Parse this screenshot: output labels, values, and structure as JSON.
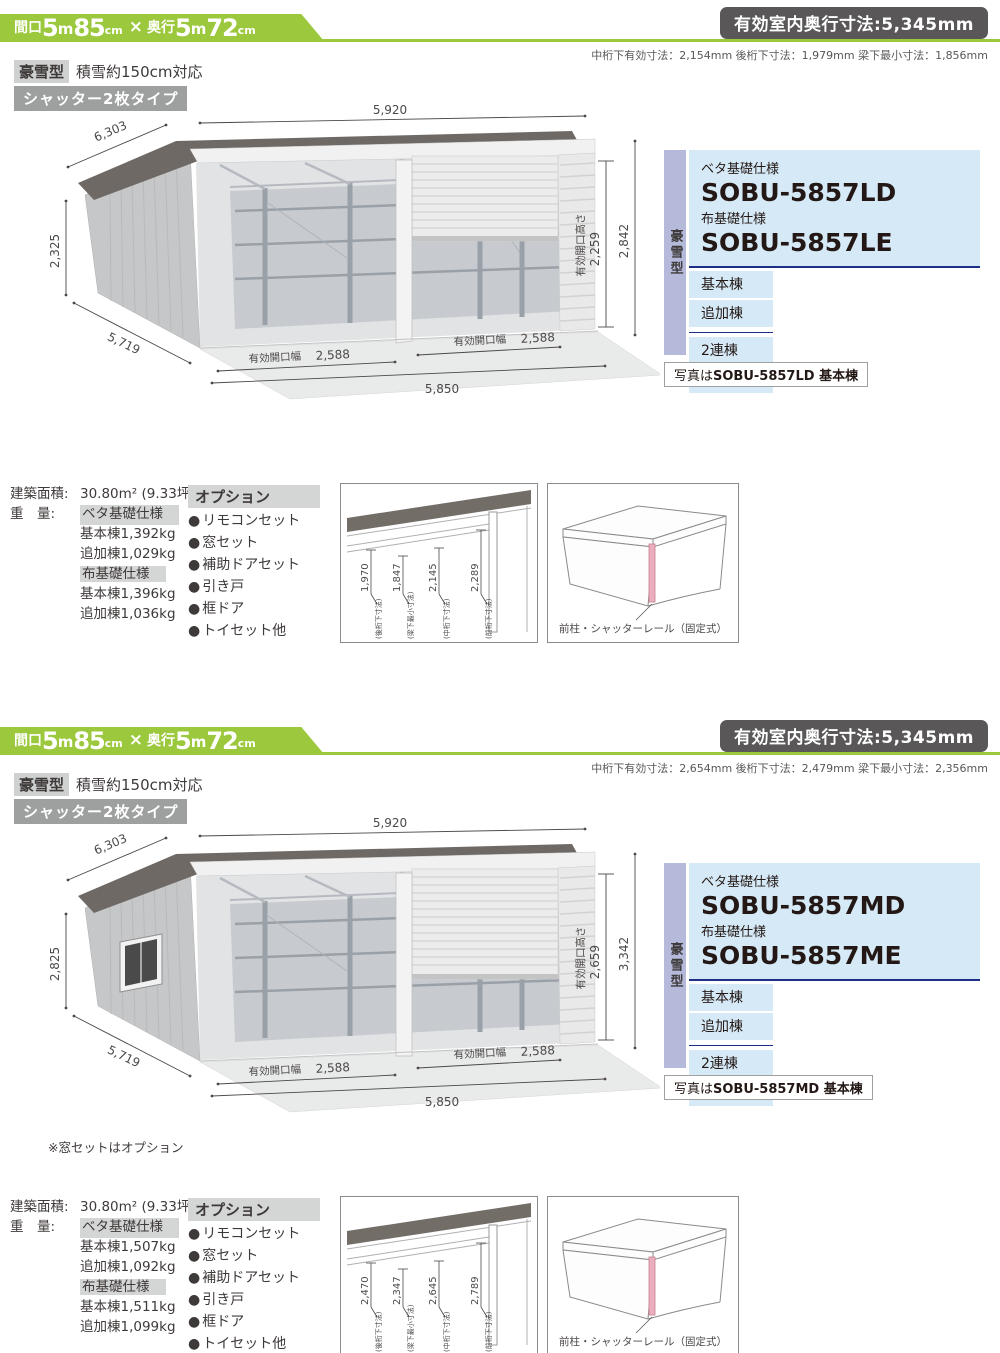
{
  "colors": {
    "accent_green": "#9cc83d",
    "badge_dark": "#595757",
    "badge_gray": "#9e9f9f",
    "panel_blue": "#d5e9f6",
    "panel_purple": "#b5badb",
    "navy_line": "#1d2e87",
    "pillar_pink": "#eaaebc"
  },
  "sections": [
    {
      "header": {
        "aperture_label": "間口",
        "a1": "5",
        "au1": "m",
        "a2": "85",
        "au2": "cm",
        "times": "×",
        "depth_label": "奥行",
        "d1": "5",
        "du1": "m",
        "d2": "72",
        "du2": "cm"
      },
      "room_badge": "有効室内奥行寸法:5,345mm",
      "subnote": "中桁下有効寸法：2,154mm 後桁下寸法：1,979mm 梁下最小寸法：1,856mm",
      "type_badge": "豪雪型",
      "type_note": "積雪約150cm対応",
      "shutter_badge": "シャッター2枚タイプ",
      "drawing": {
        "top": "5,920",
        "roof_diag": "6,303",
        "left_h": "2,325",
        "side_diag": "5,719",
        "outer_h": "2,842",
        "open_h_label": "有効開口高さ",
        "open_h": "2,259",
        "open_w_label": "有効開口幅",
        "open_w": "2,588",
        "total": "5,850"
      },
      "products": {
        "type_vertical": "豪雪型",
        "beta_label": "ベタ基礎仕様",
        "beta_model": "SOBU-5857LD",
        "nuno_label": "布基礎仕様",
        "nuno_model": "SOBU-5857LE",
        "units": [
          "基本棟",
          "追加棟"
        ],
        "multi": [
          "2連棟",
          "3連棟"
        ],
        "photo_prefix": "写真は",
        "photo_bold": "SOBU-5857LD 基本棟"
      },
      "specs": {
        "area_label": "建築面積:",
        "area_value": "30.80m² (9.33坪)",
        "weight_label": "重　量:",
        "beta_header": "ベタ基礎仕様",
        "rows_beta": [
          "基本棟1,392kg",
          "追加棟1,029kg"
        ],
        "nuno_header": "布基礎仕様",
        "rows_nuno": [
          "基本棟1,396kg",
          "追加棟1,036kg"
        ]
      },
      "options": {
        "title": "オプション",
        "bullet": "●",
        "items": [
          "リモコンセット",
          "窓セット",
          "補助ドアセット",
          "引き戸",
          "框ドア",
          "トイセット他"
        ]
      },
      "section_diagram": {
        "dims": [
          "1,970",
          "1,847",
          "2,145",
          "2,289"
        ],
        "labels": [
          "(後桁下寸法)",
          "(梁下最小寸法)",
          "(中桁下寸法)",
          "(前桁下寸法)"
        ]
      },
      "pillar_diagram": {
        "label": "前柱・シャッターレール（固定式）"
      }
    },
    {
      "header": {
        "aperture_label": "間口",
        "a1": "5",
        "au1": "m",
        "a2": "85",
        "au2": "cm",
        "times": "×",
        "depth_label": "奥行",
        "d1": "5",
        "du1": "m",
        "d2": "72",
        "du2": "cm"
      },
      "room_badge": "有効室内奥行寸法:5,345mm",
      "subnote": "中桁下有効寸法：2,654mm 後桁下寸法：2,479mm 梁下最小寸法：2,356mm",
      "type_badge": "豪雪型",
      "type_note": "積雪約150cm対応",
      "shutter_badge": "シャッター2枚タイプ",
      "drawing": {
        "top": "5,920",
        "roof_diag": "6,303",
        "left_h": "2,825",
        "side_diag": "5,719",
        "outer_h": "3,342",
        "open_h_label": "有効開口高さ",
        "open_h": "2,659",
        "open_w_label": "有効開口幅",
        "open_w": "2,588",
        "total": "5,850",
        "window_note": "※窓セットはオプション"
      },
      "products": {
        "type_vertical": "豪雪型",
        "beta_label": "ベタ基礎仕様",
        "beta_model": "SOBU-5857MD",
        "nuno_label": "布基礎仕様",
        "nuno_model": "SOBU-5857ME",
        "units": [
          "基本棟",
          "追加棟"
        ],
        "multi": [
          "2連棟",
          "3連棟"
        ],
        "photo_prefix": "写真は",
        "photo_bold": "SOBU-5857MD 基本棟"
      },
      "specs": {
        "area_label": "建築面積:",
        "area_value": "30.80m² (9.33坪)",
        "weight_label": "重　量:",
        "beta_header": "ベタ基礎仕様",
        "rows_beta": [
          "基本棟1,507kg",
          "追加棟1,092kg"
        ],
        "nuno_header": "布基礎仕様",
        "rows_nuno": [
          "基本棟1,511kg",
          "追加棟1,099kg"
        ]
      },
      "options": {
        "title": "オプション",
        "bullet": "●",
        "items": [
          "リモコンセット",
          "窓セット",
          "補助ドアセット",
          "引き戸",
          "框ドア",
          "トイセット他"
        ]
      },
      "section_diagram": {
        "dims": [
          "2,470",
          "2,347",
          "2,645",
          "2,789"
        ],
        "labels": [
          "(後桁下寸法)",
          "(梁下最小寸法)",
          "(中桁下寸法)",
          "(前桁下寸法)"
        ]
      },
      "pillar_diagram": {
        "label": "前柱・シャッターレール（固定式）"
      }
    }
  ]
}
